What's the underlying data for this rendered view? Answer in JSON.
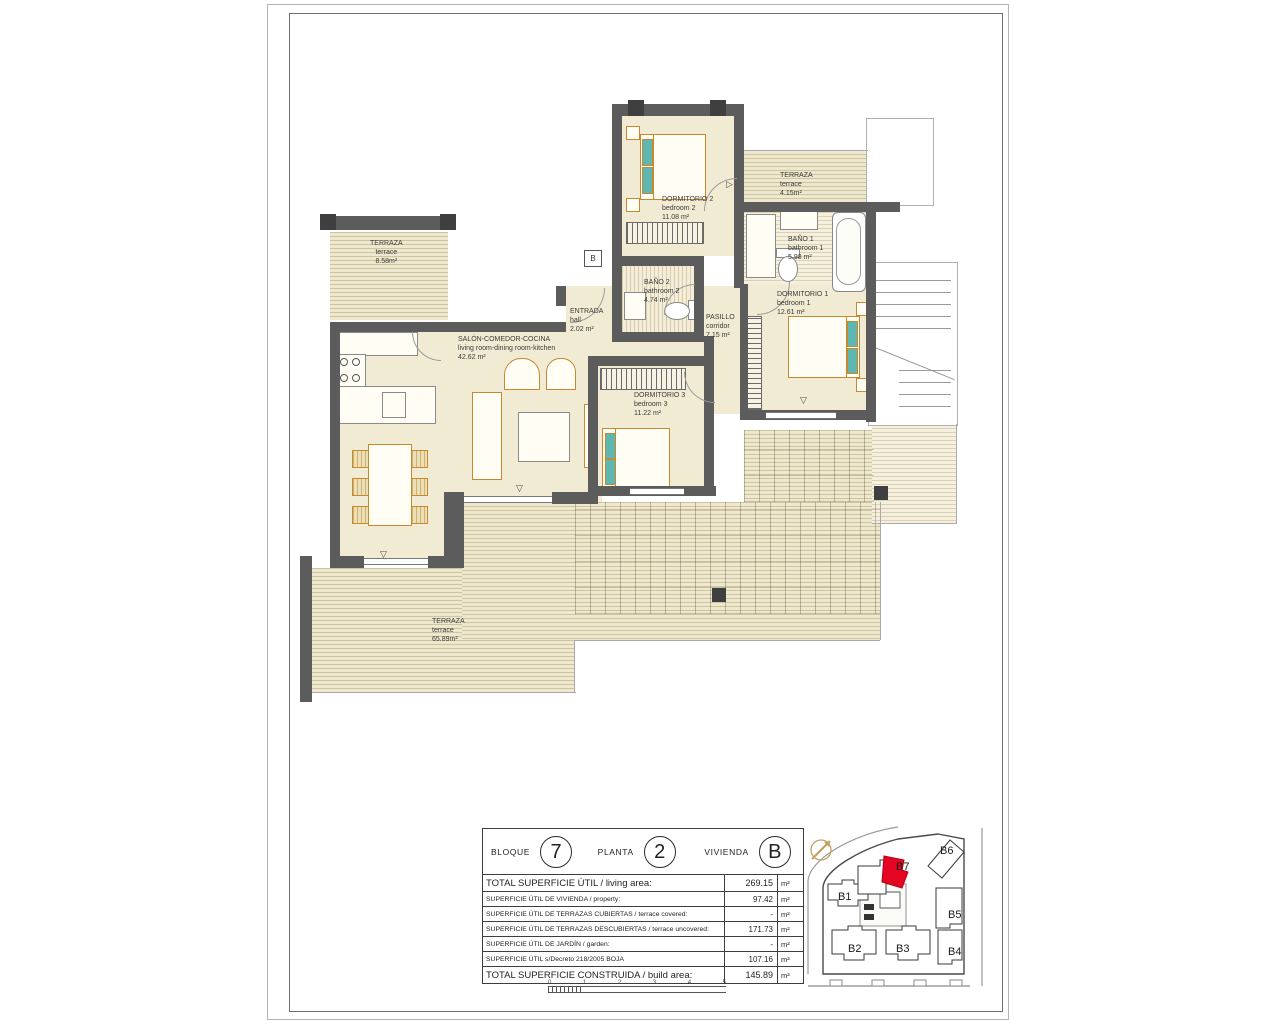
{
  "rooms": [
    {
      "name_es": "TERRAZA",
      "name_en": "terrace",
      "area": "8.58m²"
    },
    {
      "name_es": "DORMITORIO 2",
      "name_en": "bedroom 2",
      "area": "11.08 m²"
    },
    {
      "name_es": "TERRAZA",
      "name_en": "terrace",
      "area": "4.15m²"
    },
    {
      "name_es": "BAÑO 1",
      "name_en": "bathroom 1",
      "area": "5.98 m²"
    },
    {
      "name_es": "DORMITORIO 1",
      "name_en": "bedroom 1",
      "area": "12.61 m²"
    },
    {
      "name_es": "BAÑO 2",
      "name_en": "bathroom 2",
      "area": "4.74 m²"
    },
    {
      "name_es": "ENTRADA",
      "name_en": "hall",
      "area": "2.02 m²"
    },
    {
      "name_es": "PASILLO",
      "name_en": "corridor",
      "area": "7.15 m²"
    },
    {
      "name_es": "SALÓN-COMEDOR-COCINA",
      "name_en": "living room-dining room-kitchen",
      "area": "42.62 m²"
    },
    {
      "name_es": "DORMITORIO 3",
      "name_en": "bedroom 3",
      "area": "11.22 m²"
    },
    {
      "name_es": "TERRAZA",
      "name_en": "terrace",
      "area": "65.89m²"
    }
  ],
  "entry_marker": "B",
  "title_block": {
    "header": [
      {
        "label": "BLOQUE",
        "value": "7"
      },
      {
        "label": "PLANTA",
        "value": "2"
      },
      {
        "label": "VIVIENDA",
        "value": "B"
      }
    ],
    "rows": [
      {
        "label": "TOTAL SUPERFICIE ÚTIL / living area:",
        "value": "269.15",
        "unit": "m²"
      },
      {
        "label": "SUPERFICIE ÚTIL DE VIVIENDA / property:",
        "value": "97.42",
        "unit": "m²"
      },
      {
        "label": "SUPERFICIE ÚTIL DE TERRAZAS CUBIERTAS / terrace covered:",
        "value": "-",
        "unit": "m²"
      },
      {
        "label": "SUPERFICIE ÚTIL DE TERRAZAS DESCUBIERTAS / terrace uncovered:",
        "value": "171.73",
        "unit": "m²"
      },
      {
        "label": "SUPERFICIE ÚTIL DE JARDÍN / garden:",
        "value": "-",
        "unit": "m²"
      },
      {
        "label": "SUPERFICIE ÚTIL s/Decreto 218/2005 BOJA",
        "value": "107.16",
        "unit": "m²"
      },
      {
        "label": "TOTAL SUPERFICIE CONSTRUIDA / build area:",
        "value": "145.89",
        "unit": "m²"
      }
    ]
  },
  "scale_bar": {
    "ticks": [
      "0",
      "1",
      "2",
      "3",
      "4",
      "5"
    ]
  },
  "site_plan": {
    "labels": [
      "B1",
      "B2",
      "B3",
      "B4",
      "B5",
      "B6",
      "B7"
    ],
    "highlighted": "B7"
  },
  "colors": {
    "wall": "#5c5c5c",
    "floor": "#f2ebd3",
    "deck_line": "#cfc49c",
    "furniture": "#c9872e",
    "teal": "#5fb7b2",
    "highlight_red": "#e30521"
  }
}
